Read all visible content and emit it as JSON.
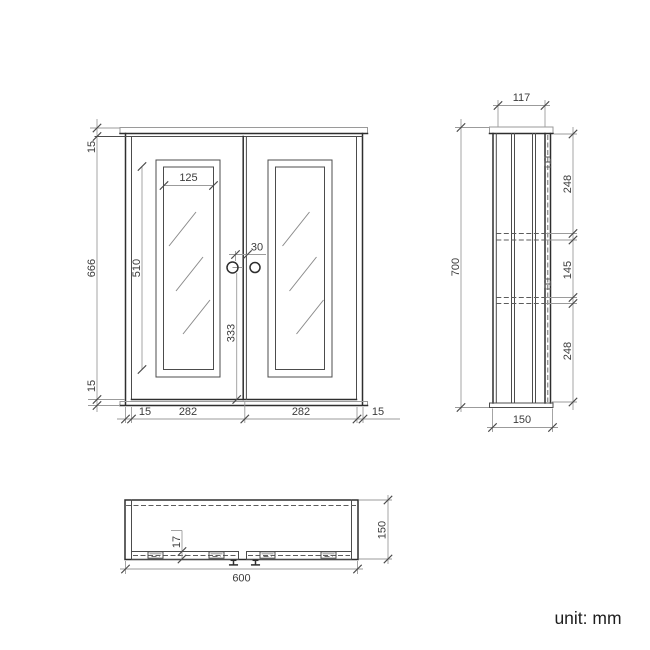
{
  "unit_note": "unit: mm",
  "colors": {
    "background": "#ffffff",
    "object_line": "#2e2e2e",
    "dimension_line": "#9b9b9b",
    "text": "#3c3c3c"
  },
  "front_view": {
    "top_thickness": "15",
    "door_height": "666",
    "bottom_thickness": "15",
    "glass_width": "125",
    "glass_height": "510",
    "knob_gap": "30",
    "knob_to_bottom": "333",
    "left_side": "15",
    "left_door_width": "282",
    "right_door_width": "282",
    "right_side": "15"
  },
  "side_view": {
    "top_depth": "117",
    "total_height": "700",
    "top_section": "248",
    "middle_section": "145",
    "bottom_section": "248",
    "bottom_depth": "150"
  },
  "bottom_view": {
    "door_thickness": "17",
    "total_width": "600",
    "total_depth": "150"
  }
}
